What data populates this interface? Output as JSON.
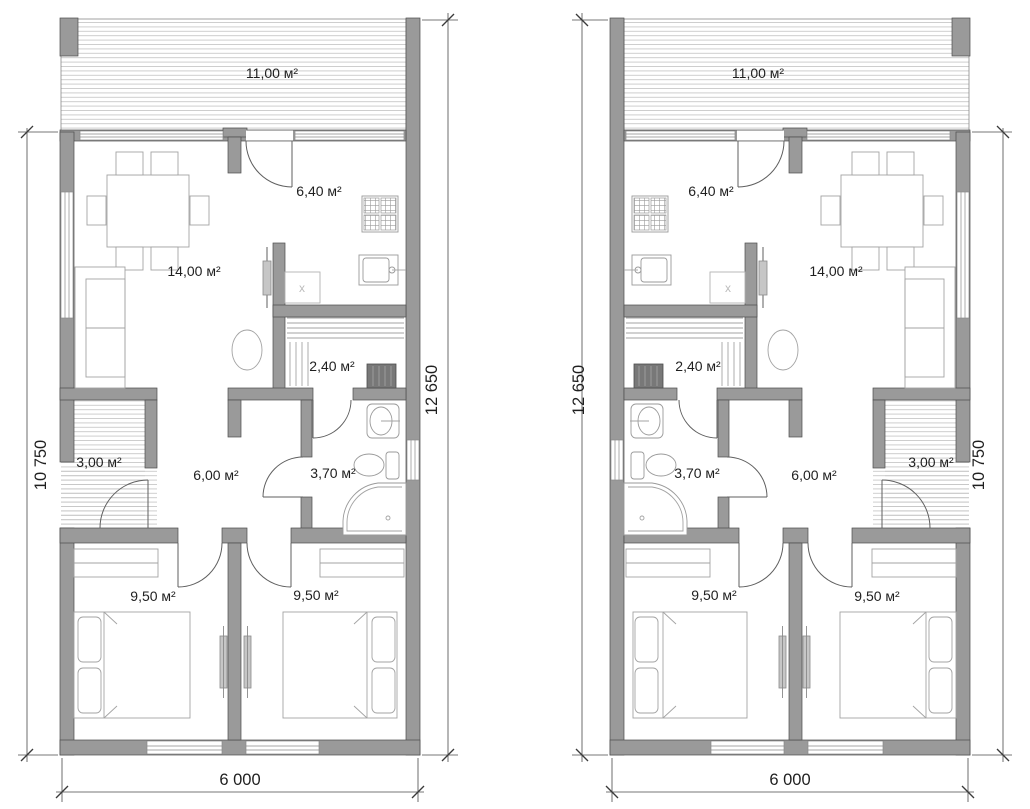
{
  "plans": [
    {
      "name": "plan-left",
      "rooms": {
        "terrace": "11,00 м²",
        "kitchen": "6,40 м²",
        "living_room": "14,00 м²",
        "sauna": "2,40 м²",
        "entry": "3,00 м²",
        "hall": "6,00 м²",
        "bathroom": "3,70 м²",
        "bedroom_left": "9,50 м²",
        "bedroom_right": "9,50 м²"
      },
      "appliance_mark": "x",
      "dimensions": {
        "left": "10 750",
        "right": "12 650",
        "bottom": "6 000"
      }
    },
    {
      "name": "plan-right",
      "rooms": {
        "terrace": "11,00 м²",
        "kitchen": "6,40 м²",
        "living_room": "14,00 м²",
        "sauna": "2,40 м²",
        "entry": "3,00 м²",
        "hall": "6,00 м²",
        "bathroom": "3,70 м²",
        "bedroom_left": "9,50 м²",
        "bedroom_right": "9,50 м²"
      },
      "appliance_mark": "x",
      "dimensions": {
        "left": "12 650",
        "right": "10 750",
        "bottom": "6 000"
      }
    }
  ]
}
